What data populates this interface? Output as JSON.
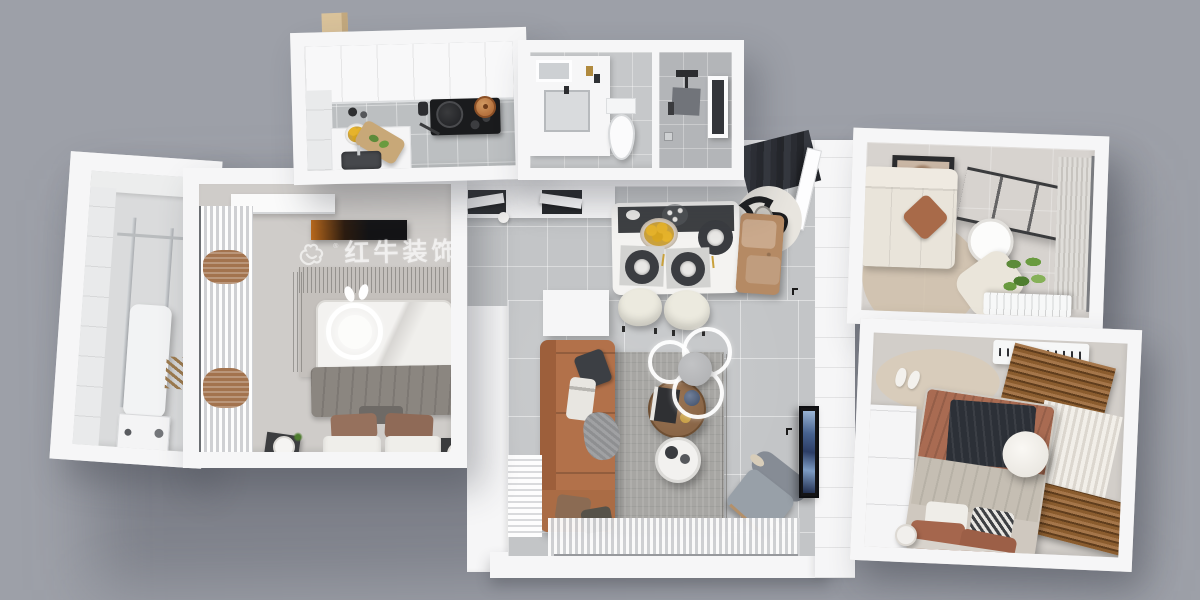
{
  "watermark": {
    "logo": "bull-icon",
    "logo_mark": "®",
    "brand_cn": "红牛装饰",
    "brand_en": "HONG NIU DECORATION"
  },
  "palette": {
    "background": "#9DA0A8",
    "wall": "#F6F6F7",
    "floor-tile": "#C3C5C7",
    "floor-warm": "#CFCCC9",
    "floor-study": "#D7D3CF",
    "floor-bed2": "#D2CEC9",
    "rug-gray": "#A7A6A3",
    "rug-beige": "#CFBFA9",
    "sofa-caramel": "#B2714A",
    "sofa-cream": "#E9E4DA",
    "chair-gray": "#98A0A8",
    "bed-rust": "#A96B52",
    "blanket-navy": "#2C3037",
    "blanket-gray": "#8B8680",
    "wood-blind": "#8A5C2E",
    "wood-table": "#8A6647",
    "lemon": "#E6B32B",
    "plant": "#5D8B3A",
    "copper-pot": "#B5713D",
    "cooktop": "#1A1B1D",
    "tv-dark": "#141416",
    "entry-bench": "#B58A64"
  },
  "rooms": [
    {
      "id": "laundry-balcony"
    },
    {
      "id": "master-bedroom"
    },
    {
      "id": "kitchen"
    },
    {
      "id": "bathroom"
    },
    {
      "id": "hallway-dining"
    },
    {
      "id": "living-room"
    },
    {
      "id": "study-room"
    },
    {
      "id": "second-bedroom"
    }
  ]
}
